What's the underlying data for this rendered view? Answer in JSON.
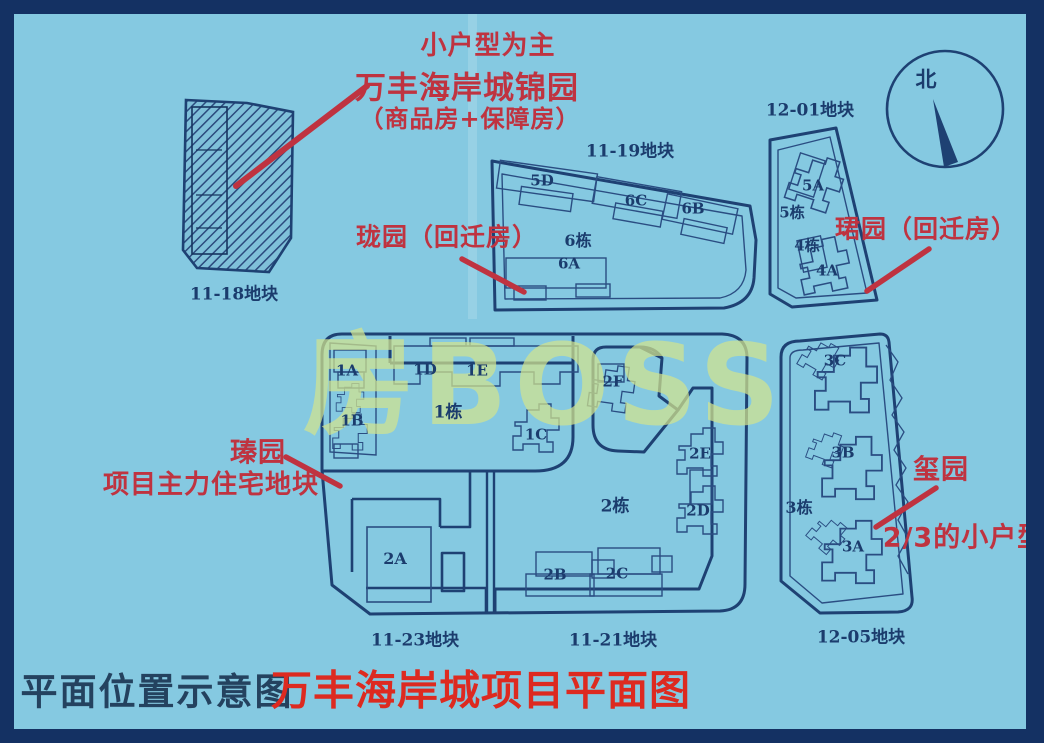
{
  "colors": {
    "background": "#85c9e1",
    "frame": "#143163",
    "plot_line": "#1e4173",
    "building_line": "#2a4d82",
    "annotation_red": "#bf3340",
    "title_red": "#dd2a20",
    "map_text_navy": "#1b3c6d",
    "watermark_yellow_green": "#d2e48e"
  },
  "watermark": {
    "text": "房BOSS"
  },
  "compass": {
    "north_label": "北"
  },
  "header_annotation": {
    "line1": "小户型为主",
    "line2": "万丰海岸城锦园",
    "line3": "（商品房+保障房）"
  },
  "annotations": {
    "longyuan": "珑园（回迁房）",
    "junyuan": "珺园（回迁房）",
    "zhenyuan_name": "瑧园",
    "zhenyuan_desc": "项目主力住宅地块",
    "xiyuan_name": "玺园",
    "xiyuan_desc": "2/3的小户型"
  },
  "plots": {
    "p11_18": {
      "label": "11-18地块"
    },
    "p11_19": {
      "label": "11-19地块",
      "b_5d": "5D",
      "b_6c": "6C",
      "b_6b": "6B",
      "b_6dong": "6栋",
      "b_6a": "6A"
    },
    "p12_01": {
      "label": "12-01地块",
      "b_5a": "5A",
      "b_5dong": "5栋",
      "b_4dong": "4栋",
      "b_4a": "4A"
    },
    "p11_23": {
      "label": "11-23地块",
      "b_1a": "1A",
      "b_1d": "1D",
      "b_1e": "1E",
      "b_1b": "1B",
      "b_1dong": "1栋",
      "b_1c": "1C",
      "b_2a": "2A"
    },
    "p11_21": {
      "label": "11-21地块",
      "b_2f": "2F",
      "b_2e": "2E",
      "b_2dong": "2栋",
      "b_2d": "2D",
      "b_2b": "2B",
      "b_2c": "2C"
    },
    "p12_05": {
      "label": "12-05地块",
      "b_3c": "3C",
      "b_3b": "3B",
      "b_3dong": "3栋",
      "b_3a": "3A"
    }
  },
  "footer": {
    "left_title": "平面位置示意图",
    "right_title": "万丰海岸城项目平面图"
  }
}
